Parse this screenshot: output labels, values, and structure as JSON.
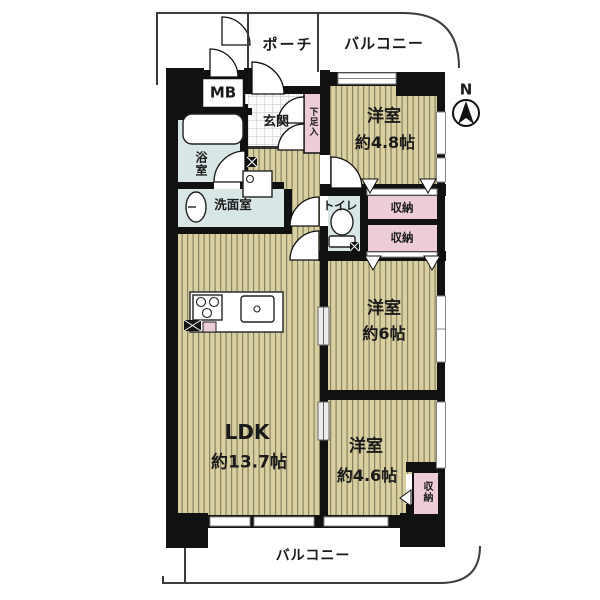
{
  "floor_plan": {
    "compass": {
      "label": "N"
    },
    "outdoor": {
      "porch": "ポーチ",
      "balcony_top": "バルコニー",
      "balcony_bottom": "バルコニー"
    },
    "utility": {
      "meter_box": "MB",
      "entrance": "玄関",
      "shoe_cabinet": "下足入",
      "bathroom": "浴室",
      "washroom": "洗面室",
      "toilet": "トイレ"
    },
    "storage": {
      "closet_upper": "収納",
      "closet_lower": "収納",
      "closet_bedroom3": "収納"
    },
    "rooms": {
      "bedroom1": {
        "name": "洋室",
        "size": "約4.8帖"
      },
      "bedroom2": {
        "name": "洋室",
        "size": "約6帖"
      },
      "bedroom3": {
        "name": "洋室",
        "size": "約4.6帖"
      },
      "ldk": {
        "name": "LDK",
        "size": "約13.7帖"
      }
    },
    "colors": {
      "room_floor": "#d9d0a2",
      "floor_stripe": "#8a8260",
      "wet_area": "#d9e6e6",
      "closet_pink": "#ecccd8",
      "wall": "#111111"
    }
  }
}
